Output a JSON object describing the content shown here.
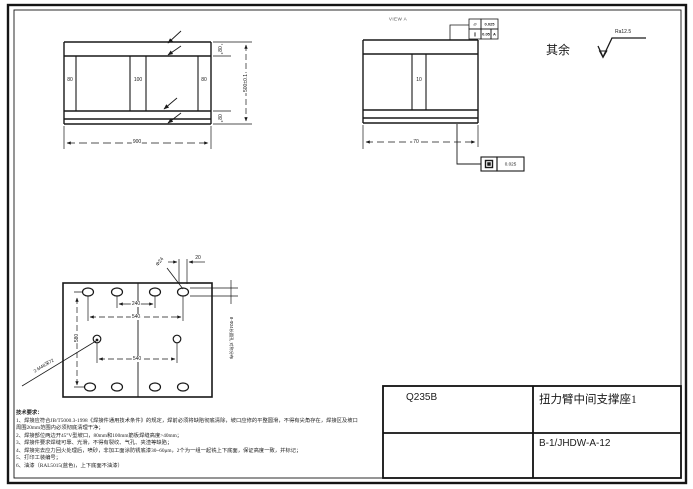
{
  "front_view": {
    "dims": {
      "web_left": "80",
      "web_center": "100",
      "web_right": "80",
      "width": "900",
      "flange_top": "80",
      "flange_bottom": "80",
      "height": "500±0.1"
    }
  },
  "view_a": {
    "label": "VIEW A",
    "dims": {
      "web": "10",
      "width": "70"
    },
    "fcf_top": {
      "r1_sym": "⏥",
      "r1_val": "0.025",
      "r2_sym": "∥",
      "r2_val": "0.05",
      "r2_datum": "A"
    },
    "fcf_bottom": {
      "sym": "⏥",
      "val": "0.025"
    }
  },
  "surface_note": {
    "text": "其余",
    "roughness": "Ra12.5"
  },
  "plate_view": {
    "dims": {
      "pitch_inner": "240",
      "pitch_outer": "540",
      "pitch_mid": "540",
      "height": "580",
      "slot_width": "20"
    },
    "callouts": {
      "slot_dia": "Φ24",
      "tapped_holes": "2-M48深72",
      "slot_holes": "8-Φ24长圆孔 对称分布"
    }
  },
  "tech_req": {
    "title": "技术要求：",
    "items": [
      "1、焊接应符合JB/T5000.3-1998《焊接件通用技术条件》的规定，焊前必须将缺陷彻底清除，坡口应修的平整圆滑，不得有尖角存在，焊接区及坡口周围20mm范围内必须彻底清理干净；",
      "2、焊接部位两边开45°V型坡口，80mm和100mm筋板焊缝高度>40mm；",
      "3、焊接件要求焊缝可靠、光滑，不得有裂纹、气孔、夹渣等缺陷；",
      "4、焊接完去应力回火处理后，喷砂，非加工面涂防锈底漆30~60μm，2个为一组一起铣上下底面，保证高度一致，并标记；",
      "5、打印工装编号；",
      "6、油漆（RAL5015(蓝色)，上下底面不油漆）"
    ]
  },
  "title_block": {
    "material": "Q235B",
    "part_name": "扭力臂中间支撑座1",
    "drawing_no": "B-1/JHDW-A-12"
  }
}
